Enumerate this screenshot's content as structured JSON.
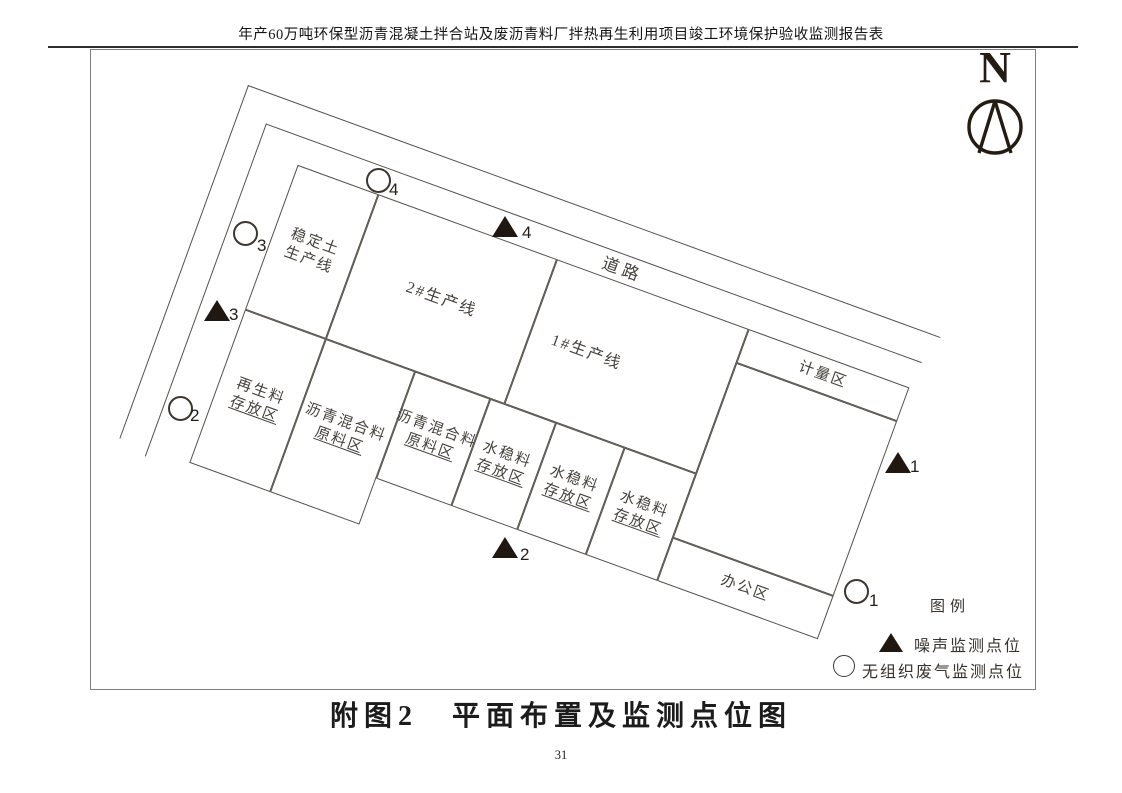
{
  "page": {
    "header": "年产60万吨环保型沥青混凝土拌合站及废沥青料厂拌热再生利用项目竣工环境保护验收监测报告表",
    "caption": "附图2　平面布置及监测点位图",
    "page_number": "31"
  },
  "compass": {
    "label": "N"
  },
  "site_plan": {
    "rotation_deg": 20,
    "road_label": "道路",
    "blocks": [
      {
        "line1": "稳定土",
        "line2": "生产线"
      },
      {
        "line1": "2#生产线"
      },
      {
        "line1": "1#生产线"
      },
      {
        "line1": "计量区"
      },
      {
        "line1": ""
      },
      {
        "line1": "办公区"
      },
      {
        "line1": "再生料",
        "line2": "存放区"
      },
      {
        "line1": "沥青混合料",
        "line2": "原料区"
      },
      {
        "line1": "沥青混合料",
        "line2": "原料区"
      },
      {
        "line1": "水稳料",
        "line2": "存放区"
      },
      {
        "line1": "水稳料",
        "line2": "存放区"
      },
      {
        "line1": "水稳料",
        "line2": "存放区"
      }
    ],
    "monitoring_points": [
      {
        "kind": "noise",
        "num": "1"
      },
      {
        "kind": "noise",
        "num": "2"
      },
      {
        "kind": "noise",
        "num": "3"
      },
      {
        "kind": "noise",
        "num": "4"
      },
      {
        "kind": "gas",
        "num": "1"
      },
      {
        "kind": "gas",
        "num": "2"
      },
      {
        "kind": "gas",
        "num": "3"
      },
      {
        "kind": "gas",
        "num": "4"
      }
    ]
  },
  "legend": {
    "title": "图例",
    "items": [
      {
        "symbol": "filled-triangle",
        "label": "噪声监测点位"
      },
      {
        "symbol": "open-circle",
        "label": "无组织废气监测点位"
      }
    ]
  },
  "colors": {
    "plan_line": "#56514b",
    "plan_text": "#46413b",
    "marker_fill": "#201710",
    "ink": "#1a1a1a"
  }
}
